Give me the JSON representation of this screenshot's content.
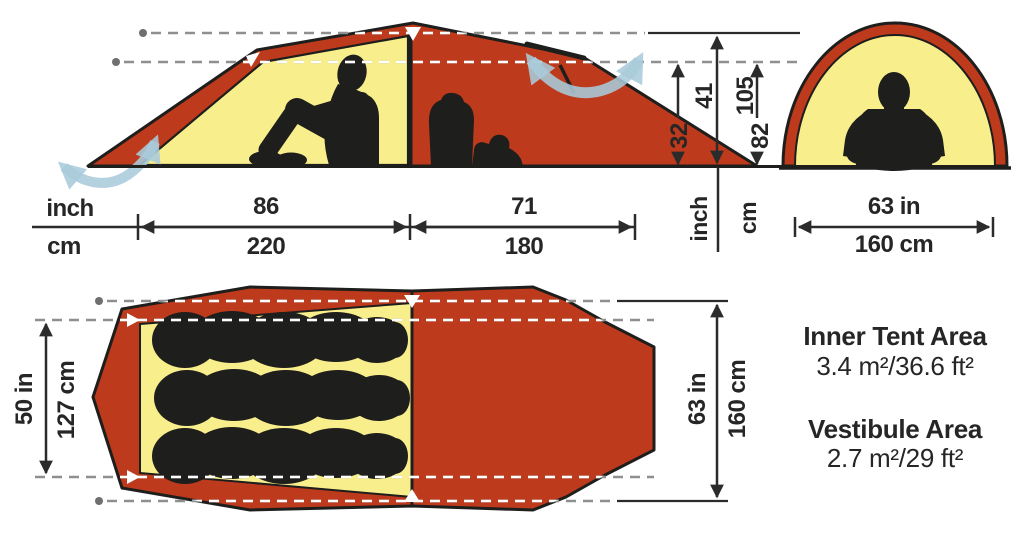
{
  "title": "Tent dimensions diagram",
  "colors": {
    "fly_red": "#BE3A1C",
    "inner_yellow": "#F8EE8C",
    "outline_dark": "#1E1E1C",
    "airflow_blue": "#A9CBDB",
    "dimension_dark": "#2b2b2b"
  },
  "side_view": {
    "length_unit_in": "inch",
    "length_unit_cm": "cm",
    "inner_length_in": "86",
    "inner_length_cm": "220",
    "vestibule_length_in": "71",
    "vestibule_length_cm": "180",
    "peak_height_in": "41",
    "peak_height_cm": "105",
    "inner_height_in": "32",
    "inner_height_cm": "82",
    "height_unit_in": "inch",
    "height_unit_cm": "cm"
  },
  "front_view": {
    "width_in": "63 in",
    "width_cm": "160 cm"
  },
  "top_view": {
    "inner_width_in": "50 in",
    "inner_width_cm": "127 cm",
    "outer_width_in": "63 in",
    "outer_width_cm": "160 cm"
  },
  "areas": {
    "inner_tent_label": "Inner Tent Area",
    "inner_tent_value": "3.4 m²/36.6 ft²",
    "vestibule_label": "Vestibule Area",
    "vestibule_value": "2.7 m²/29 ft²"
  }
}
